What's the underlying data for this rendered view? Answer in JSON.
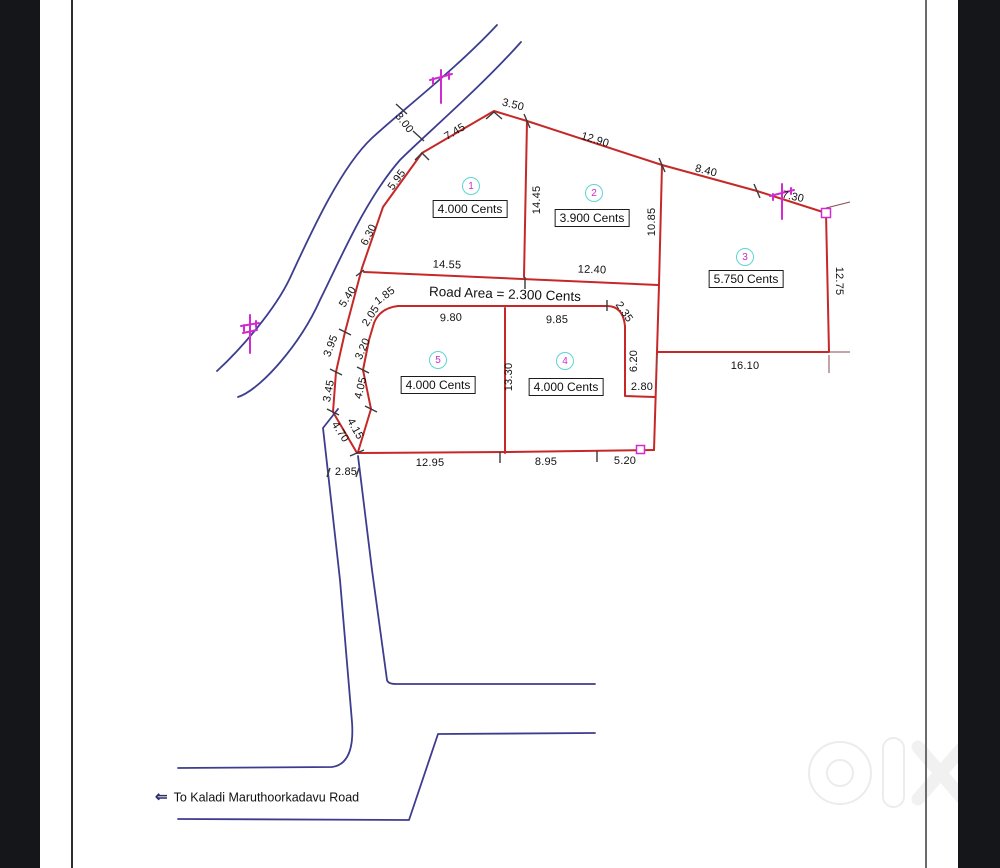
{
  "watermark": {
    "brand": "olx",
    "country": "INDIA"
  },
  "colors": {
    "boundary_red": "#c62828",
    "road_blue": "#3d3d8f",
    "marker_magenta": "#cf2bcf",
    "plot_circle_cyan": "#5ed5d5"
  },
  "icons": {
    "left_arrow": "⇐"
  },
  "drawing": {
    "road_area_label": "Road Area = 2.300 Cents",
    "destination_label": "To Kaladi Maruthoorkadavu Road",
    "plots": [
      {
        "number": "1",
        "area": "4.000 Cents"
      },
      {
        "number": "2",
        "area": "3.900 Cents"
      },
      {
        "number": "3",
        "area": "5.750 Cents"
      },
      {
        "number": "4",
        "area": "4.000 Cents"
      },
      {
        "number": "5",
        "area": "4.000 Cents"
      }
    ],
    "dimensions": {
      "d300": "3.00",
      "d745": "7.45",
      "d350": "3.50",
      "d1290": "12.90",
      "d840": "8.40",
      "d730": "7.30",
      "d595": "5.95",
      "d630": "6.30",
      "d540": "5.40",
      "d395": "3.95",
      "d345": "3.45",
      "d470": "4.70",
      "d185": "1.85",
      "d205": "2.05",
      "d320": "3.20",
      "d405": "4.05",
      "d415": "4.15",
      "d1445": "14.45",
      "d1085": "10.85",
      "d1275": "12.75",
      "d1455": "14.55",
      "d1240": "12.40",
      "d980": "9.80",
      "d985": "9.85",
      "d235": "2.35",
      "d1330": "13.30",
      "d620": "6.20",
      "d280": "2.80",
      "d1610": "16.10",
      "d1295": "12.95",
      "d895": "8.95",
      "d520": "5.20",
      "d285": "2.85"
    }
  }
}
